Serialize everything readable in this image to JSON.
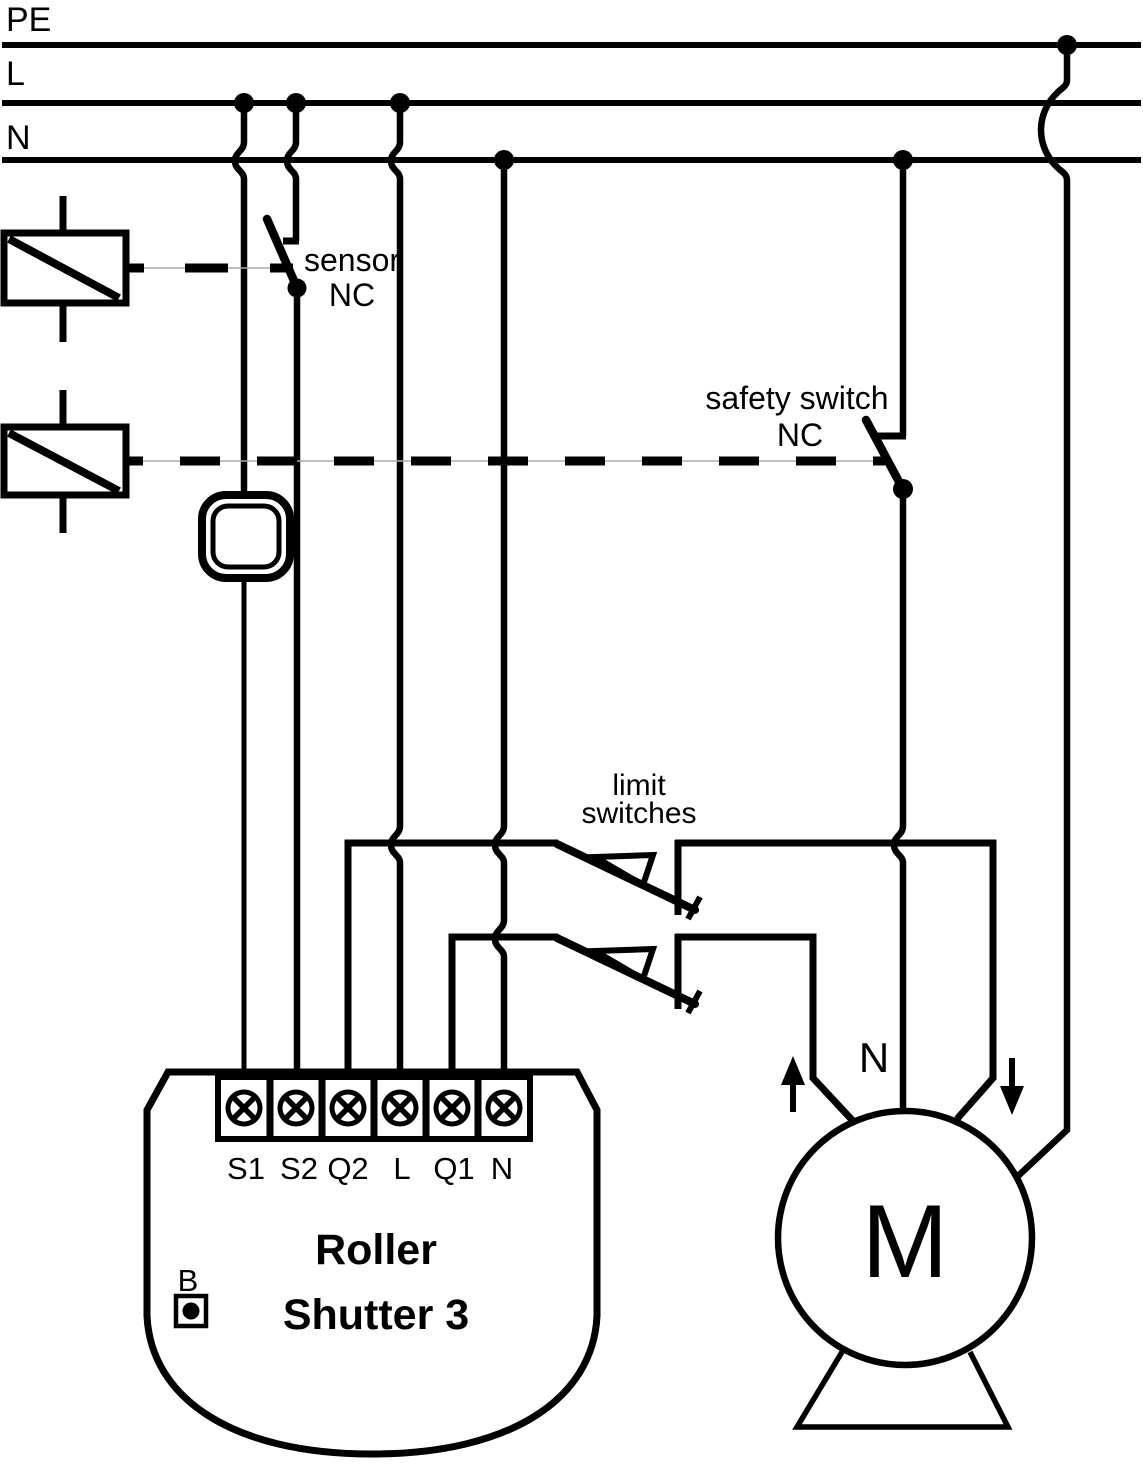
{
  "colors": {
    "ink": "#000000",
    "background": "#ffffff",
    "mechanical_link_hairline": "#aaaaaa"
  },
  "buses": {
    "pe_label": "PE",
    "line_label": "L",
    "neutral_label": "N"
  },
  "annotations": {
    "sensor": {
      "line1": "sensor",
      "line2": "NC"
    },
    "safety_switch": {
      "line1": "safety switch",
      "line2": "NC"
    },
    "limit_switches": {
      "line1": "limit",
      "line2": "switches"
    },
    "motor_neutral_label": "N"
  },
  "device": {
    "name_line1": "Roller",
    "name_line2": "Shutter 3",
    "service_button_label": "B",
    "terminals": [
      "S1",
      "S2",
      "Q2",
      "L",
      "Q1",
      "N"
    ]
  },
  "motor": {
    "label": "M"
  }
}
